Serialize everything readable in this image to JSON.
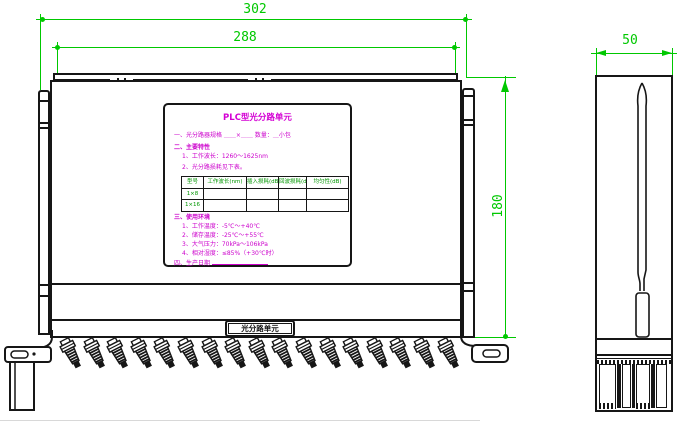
{
  "drawing": {
    "dimensions": {
      "overall_width": "302",
      "mounting_width": "288",
      "body_height": "180",
      "depth": "50"
    },
    "nameplate": {
      "title": "PLC型光分路单元",
      "line1": "一、光分路器规格 ＿＿×＿＿ 数量：＿小包",
      "section2_heading": "二、主要特性",
      "section2_items": [
        "1、工作波长：1260～1625nm",
        "2、光分路损耗见下表。"
      ],
      "table": {
        "headers": [
          "型号",
          "工作波长(nm)",
          "插入损耗(dB)",
          "回波损耗(dB)",
          "均匀性(dB)"
        ],
        "rows": [
          [
            "1×8",
            "",
            "",
            "",
            ""
          ],
          [
            "1×16",
            "",
            "",
            "",
            ""
          ]
        ]
      },
      "section3_heading": "三、使用环境",
      "section3_items": [
        "1、工作温度：-5℃～+40℃",
        "2、储存温度：-25℃～+55℃",
        "3、大气压力：70kPa～106kPa",
        "4、相对湿度：≤85%（+30℃时）"
      ],
      "footer_label": "四、生产日期",
      "footer_blank": "＿＿＿＿＿＿"
    },
    "panel_label": "光分路单元",
    "connectors": {
      "count": 17
    },
    "colors": {
      "dimension_line": "#00c800",
      "nameplate_text": "#cc00cc",
      "table_text": "#009600",
      "outline": "#161616",
      "background": "#ffffff"
    }
  }
}
